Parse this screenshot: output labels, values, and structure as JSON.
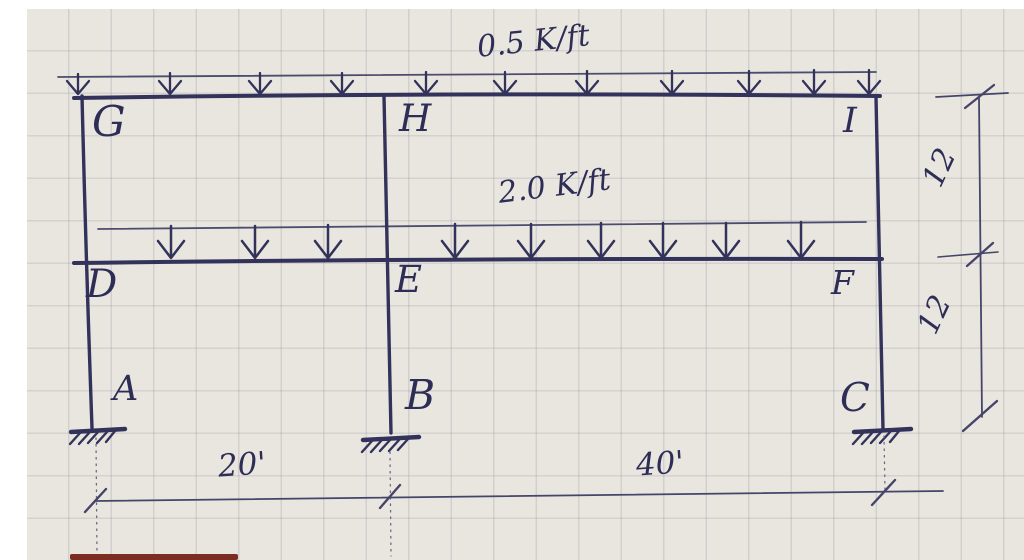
{
  "figure": {
    "description": "Hand-drawn two-story structural frame on graph paper with distributed loads",
    "paper_color": "#e9e6e0",
    "ink_color": "#32325a",
    "loads": {
      "top_label": "0.5 K/ft",
      "middle_label": "2.0 K/ft",
      "arrow_icon": "↓"
    },
    "joints": {
      "top_left": "G",
      "top_center": "H",
      "top_right": "I",
      "mid_left": "D",
      "mid_center": "E",
      "mid_right": "F"
    },
    "supports": {
      "left": "A",
      "center": "B",
      "right": "C",
      "type": "fixed"
    },
    "dimensions": {
      "bottom_left_span": "20'",
      "bottom_right_span": "40'",
      "upper_story_height": "12",
      "lower_story_height": "12"
    }
  }
}
